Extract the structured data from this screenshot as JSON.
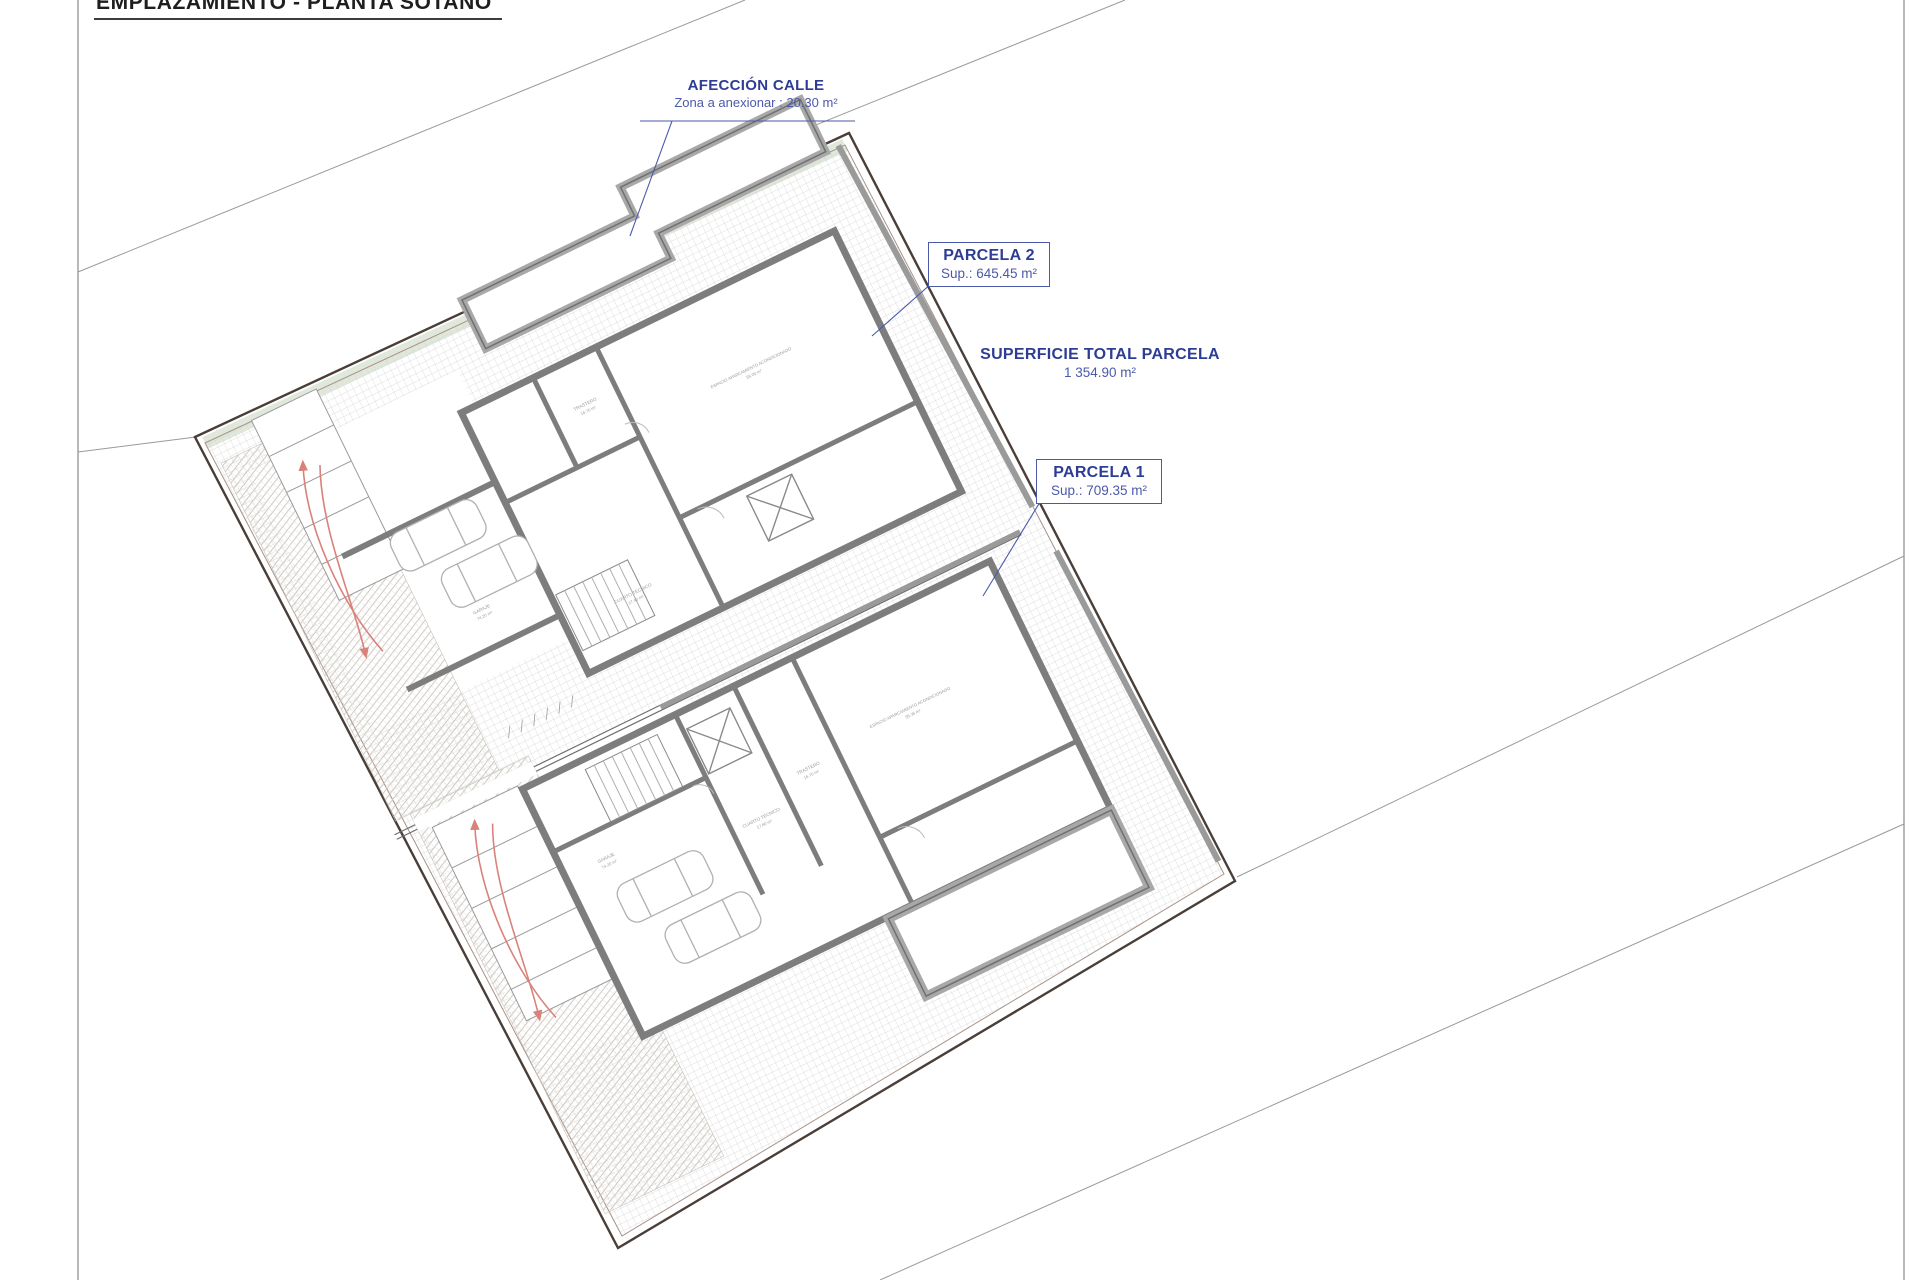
{
  "title": "EMPLAZAMIENTO - PLANTA SÓTANO",
  "annotations": {
    "afeccion_calle": {
      "heading": "AFECCIÓN CALLE",
      "detail": "Zona a anexionar : 20.30 m²"
    },
    "parcela_2": {
      "heading": "PARCELA 2",
      "detail": "Sup.: 645.45 m²"
    },
    "superficie_total": {
      "heading": "SUPERFICIE TOTAL PARCELA",
      "detail": "1 354.90 m²"
    },
    "parcela_1": {
      "heading": "PARCELA 1",
      "detail": "Sup.: 709.35 m²"
    }
  },
  "rooms": {
    "p2_main": {
      "l1": "ESPACIO APARCAMIENTO ACONDICIONADO",
      "l2": "56.00 m²"
    },
    "p2_trastero": {
      "l1": "TRASTERO",
      "l2": "16.70 m²"
    },
    "p2_tecnico": {
      "l1": "CUARTO TÉCNICO",
      "l2": "17.40 m²"
    },
    "p2_garaje": {
      "l1": "GARAJE",
      "l2": "74.20 m²"
    },
    "p1_main": {
      "l1": "ESPACIO APARCAMIENTO ACONDICIONADO",
      "l2": "55.35 m²"
    },
    "p1_trastero": {
      "l1": "TRASTERO",
      "l2": "16.70 m²"
    },
    "p1_tecnico": {
      "l1": "CUARTO TÉCNICO",
      "l2": "17.80 m²"
    },
    "p1_garaje": {
      "l1": "GARAJE",
      "l2": "74.20 m²"
    }
  },
  "colors": {
    "annotation_blue": "#2e3d94",
    "leader_blue": "#4a5aa8",
    "arrow_red": "#d9827a",
    "wall_gray": "#7d7d7d",
    "boundary_brown": "#4a3f38",
    "hatch_gray": "#d4d4d4"
  }
}
